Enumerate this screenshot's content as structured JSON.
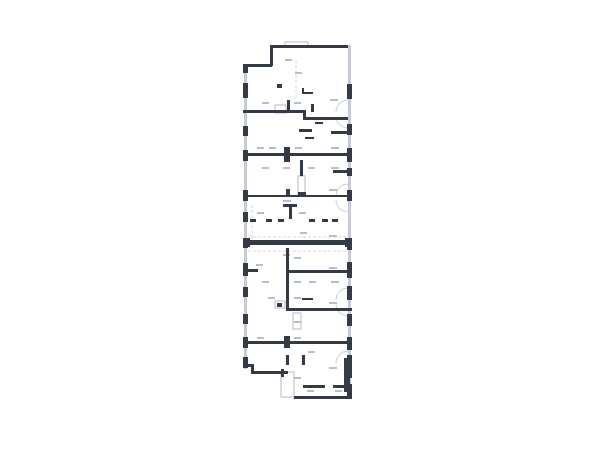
{
  "title": "architectural-floor-plan",
  "colors": {
    "background": "#ffffff",
    "wall_dark": "#343a46",
    "wall_light": "#c7cbd2",
    "outline_stroke": "#b6bac2",
    "label_smudge": "#b9bdc5",
    "door_arc": "#c9cdd4"
  },
  "plan": {
    "light_strips": [
      [
        244,
        64,
        3,
        305
      ],
      [
        348,
        45,
        3,
        353
      ]
    ],
    "dashed": [
      [
        248,
        237,
        348,
        237
      ],
      [
        248,
        251,
        348,
        251
      ],
      [
        252,
        205,
        252,
        240
      ],
      [
        296,
        60,
        296,
        100
      ]
    ],
    "outlines": [
      [
        285,
        42,
        23,
        5
      ],
      [
        275,
        105,
        11,
        8
      ],
      [
        298,
        176,
        7,
        19
      ],
      [
        293,
        313,
        8,
        16
      ],
      [
        281,
        372,
        13,
        25
      ],
      [
        275,
        301,
        10,
        7
      ]
    ],
    "arcs": [
      [
        348,
        112,
        12,
        "up"
      ],
      [
        348,
        116,
        12,
        "down"
      ],
      [
        348,
        196,
        12,
        "up"
      ],
      [
        348,
        200,
        12,
        "down"
      ],
      [
        348,
        300,
        12,
        "up"
      ],
      [
        348,
        304,
        12,
        "down"
      ],
      [
        348,
        363,
        12,
        "up"
      ]
    ],
    "smudges": [
      [
        285,
        59,
        7,
        2
      ],
      [
        295,
        72,
        7,
        2
      ],
      [
        262,
        102,
        7,
        2
      ],
      [
        294,
        102,
        7,
        2
      ],
      [
        330,
        99,
        8,
        2
      ],
      [
        257,
        147,
        7,
        2
      ],
      [
        269,
        147,
        7,
        2
      ],
      [
        295,
        147,
        7,
        2
      ],
      [
        331,
        147,
        8,
        2
      ],
      [
        262,
        167,
        7,
        2
      ],
      [
        283,
        167,
        7,
        2
      ],
      [
        308,
        167,
        7,
        2
      ],
      [
        331,
        167,
        8,
        2
      ],
      [
        257,
        212,
        7,
        2
      ],
      [
        299,
        212,
        7,
        2
      ],
      [
        329,
        189,
        8,
        2
      ],
      [
        329,
        235,
        8,
        2
      ],
      [
        283,
        200,
        8,
        2
      ],
      [
        300,
        232,
        7,
        2
      ],
      [
        283,
        254,
        7,
        2
      ],
      [
        294,
        257,
        7,
        2
      ],
      [
        256,
        264,
        7,
        2
      ],
      [
        329,
        267,
        8,
        2
      ],
      [
        262,
        281,
        7,
        2
      ],
      [
        294,
        281,
        7,
        2
      ],
      [
        309,
        281,
        7,
        2
      ],
      [
        331,
        281,
        8,
        2
      ],
      [
        268,
        297,
        7,
        2
      ],
      [
        294,
        297,
        7,
        2
      ],
      [
        329,
        302,
        8,
        2
      ],
      [
        294,
        321,
        7,
        2
      ],
      [
        257,
        337,
        7,
        2
      ],
      [
        294,
        337,
        7,
        2
      ],
      [
        308,
        351,
        7,
        2
      ],
      [
        329,
        367,
        8,
        2
      ],
      [
        294,
        377,
        7,
        2
      ],
      [
        307,
        390,
        7,
        2
      ],
      [
        335,
        390,
        7,
        2
      ]
    ],
    "dark": [
      [
        270,
        45,
        78,
        3
      ],
      [
        270,
        45,
        3,
        21
      ],
      [
        243,
        64,
        29,
        3
      ],
      [
        243,
        64,
        5,
        9
      ],
      [
        243,
        83,
        5,
        15
      ],
      [
        243,
        126,
        5,
        10
      ],
      [
        243,
        150,
        5,
        11
      ],
      [
        243,
        190,
        5,
        11
      ],
      [
        243,
        212,
        5,
        10
      ],
      [
        243,
        238,
        5,
        10
      ],
      [
        243,
        263,
        5,
        13
      ],
      [
        243,
        287,
        5,
        10
      ],
      [
        243,
        314,
        5,
        10
      ],
      [
        243,
        337,
        5,
        11
      ],
      [
        243,
        357,
        5,
        11
      ],
      [
        347,
        84,
        5,
        15
      ],
      [
        347,
        124,
        5,
        11
      ],
      [
        347,
        148,
        5,
        14
      ],
      [
        347,
        168,
        5,
        8
      ],
      [
        347,
        190,
        5,
        11
      ],
      [
        347,
        238,
        5,
        12
      ],
      [
        347,
        262,
        5,
        16
      ],
      [
        347,
        286,
        5,
        14
      ],
      [
        347,
        314,
        5,
        12
      ],
      [
        347,
        337,
        5,
        13
      ],
      [
        347,
        355,
        5,
        23
      ],
      [
        347,
        384,
        5,
        14
      ],
      [
        243,
        110,
        62,
        3
      ],
      [
        303,
        110,
        3,
        9
      ],
      [
        303,
        117,
        45,
        3
      ],
      [
        299,
        129,
        13,
        3
      ],
      [
        331,
        131,
        21,
        3
      ],
      [
        243,
        153,
        109,
        3
      ],
      [
        284,
        147,
        6,
        15
      ],
      [
        300,
        160,
        3,
        16
      ],
      [
        333,
        170,
        19,
        3
      ],
      [
        298,
        192,
        8,
        4
      ],
      [
        243,
        195,
        109,
        2
      ],
      [
        286,
        189,
        4,
        8
      ],
      [
        283,
        204,
        14,
        3
      ],
      [
        289,
        204,
        3,
        15
      ],
      [
        250,
        219,
        6,
        3
      ],
      [
        266,
        219,
        6,
        3
      ],
      [
        278,
        219,
        6,
        3
      ],
      [
        309,
        219,
        6,
        3
      ],
      [
        322,
        219,
        6,
        3
      ],
      [
        332,
        219,
        6,
        3
      ],
      [
        243,
        240,
        109,
        5
      ],
      [
        243,
        238,
        7,
        9
      ],
      [
        345,
        238,
        7,
        9
      ],
      [
        286,
        248,
        3,
        62
      ],
      [
        286,
        270,
        66,
        3
      ],
      [
        243,
        269,
        15,
        3
      ],
      [
        286,
        308,
        66,
        3
      ],
      [
        286,
        355,
        3,
        10
      ],
      [
        302,
        355,
        3,
        10
      ],
      [
        243,
        341,
        109,
        3
      ],
      [
        284,
        336,
        6,
        12
      ],
      [
        303,
        385,
        22,
        3
      ],
      [
        333,
        385,
        12,
        3
      ],
      [
        344,
        358,
        6,
        34
      ],
      [
        243,
        364,
        10,
        3
      ],
      [
        251,
        364,
        3,
        10
      ],
      [
        251,
        371,
        37,
        3
      ],
      [
        281,
        369,
        3,
        8
      ],
      [
        294,
        396,
        58,
        3
      ],
      [
        277,
        84,
        5,
        4
      ],
      [
        302,
        92,
        11,
        2
      ],
      [
        302,
        88,
        2,
        6
      ],
      [
        305,
        137,
        9,
        2
      ],
      [
        311,
        104,
        3,
        8
      ],
      [
        287,
        100,
        3,
        10
      ],
      [
        315,
        122,
        8,
        2
      ],
      [
        302,
        298,
        11,
        2
      ],
      [
        277,
        303,
        5,
        4
      ]
    ]
  }
}
